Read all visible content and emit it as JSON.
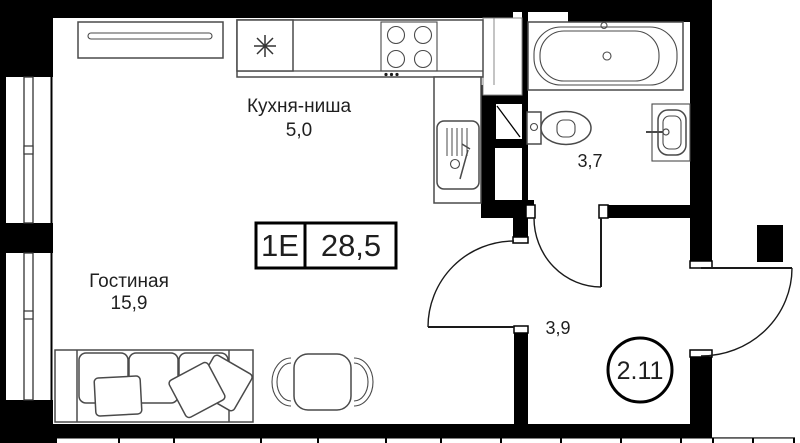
{
  "plan_title": {
    "type_code": "1Е",
    "total_area": "28,5"
  },
  "rooms": {
    "kitchen": {
      "label": "Кухня-ниша",
      "area": "5,0"
    },
    "living_room": {
      "label": "Гостиная",
      "area": "15,9"
    },
    "bathroom": {
      "area": "3,7"
    },
    "hallway": {
      "area": "3,9"
    }
  },
  "unit_number": "2.11",
  "colors": {
    "wall": "#000000",
    "furniture_line": "#4a4a4a",
    "background": "#ffffff",
    "text": "#1f1f1f"
  },
  "icons": {
    "fridge": "snowflake-asterisk-icon",
    "stove": "four-burner-stove-icon",
    "kitchen_sink": "kitchen-sink-icon",
    "bathtub": "bathtub-icon",
    "toilet": "toilet-icon",
    "wash_basin": "wash-basin-icon",
    "sofa": "sofa-icon",
    "dining_table": "table-with-chairs-icon",
    "wardrobe": "wardrobe-icon",
    "vent_shaft": "vent-shaft-icon",
    "window": "window-icon"
  }
}
